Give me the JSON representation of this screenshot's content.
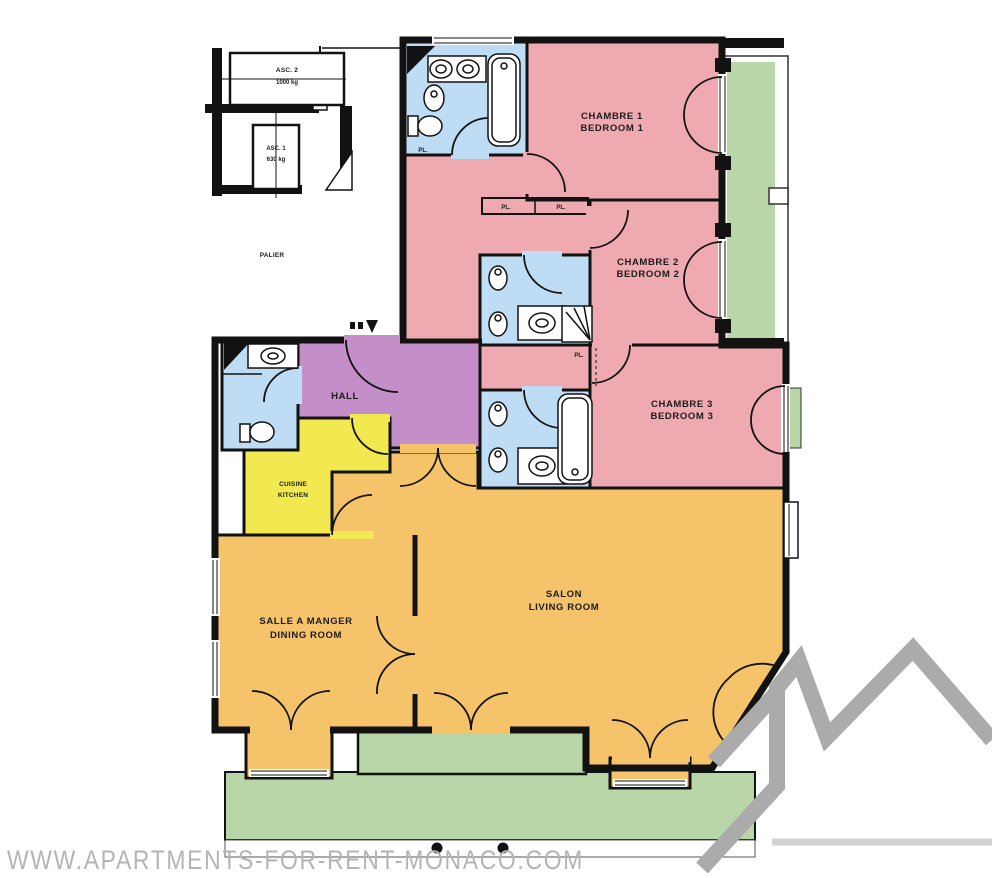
{
  "title": "Apartment floor plan",
  "watermark": "WWW.APARTMENTS-FOR-RENT-MONACO.COM",
  "landing": {
    "label": "PALIER",
    "elevators": [
      {
        "name": "ASC. 2",
        "capacity": "1000 kg"
      },
      {
        "name": "ASC. 1",
        "capacity": "630 kg"
      }
    ]
  },
  "rooms": {
    "bedroom1": {
      "name_fr": "CHAMBRE 1",
      "name_en": "BEDROOM 1"
    },
    "bedroom2": {
      "name_fr": "CHAMBRE 2",
      "name_en": "BEDROOM 2"
    },
    "bedroom3": {
      "name_fr": "CHAMBRE 3",
      "name_en": "BEDROOM 3"
    },
    "hall": {
      "name": "HALL"
    },
    "kitchen": {
      "name_fr": "CUISINE",
      "name_en": "KITCHEN"
    },
    "dining_room": {
      "name_fr": "SALLE A MANGER",
      "name_en": "DINING ROOM"
    },
    "living_room": {
      "name_fr": "SALON",
      "name_en": "LIVING ROOM"
    }
  },
  "closet_label": "PL.",
  "colors": {
    "bedroom_pink": "#efa9b0",
    "bathroom_blue": "#bedcf4",
    "hall_purple": "#c48fc8",
    "kitchen_yellow": "#f1e94f",
    "living_orange": "#f5c36a",
    "terrace_green": "#b9d6a9",
    "wall_black": "#121212",
    "watermark_gray": "#b4b4b4",
    "logo_gray": "#ababab"
  }
}
